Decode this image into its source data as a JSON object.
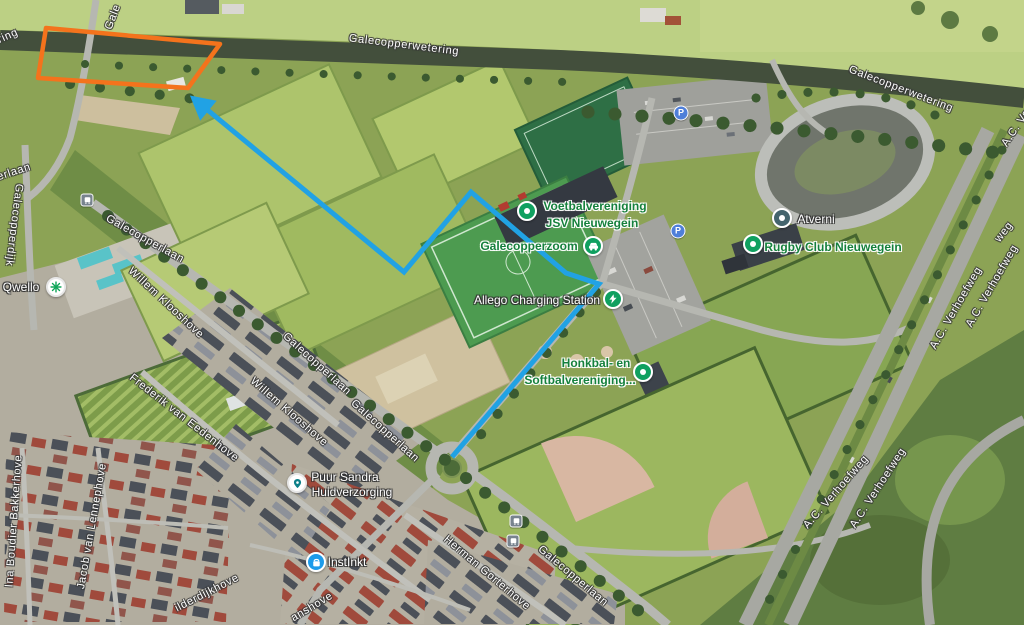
{
  "streets": {
    "galecopperwetering": "Galecopperwetering",
    "galecopperlaan": "Galecopperlaan",
    "galecopperdijk": "Galecopperdijk",
    "willem_klooshove": "Willem Klooshove",
    "frederik_van_eedenhove": "Frederik van Eedenhove",
    "ina_boudier_bakkerhove": "Ina Boudier Bakkerhove",
    "jacob_van_lennephove": "Jacob van Lennephove",
    "herman_gorterhove": "Herman Gorterhove",
    "ac_verhoefweg": "A.C. Verhoefweg",
    "partial_ring": "ring",
    "partial_gale": "Gale",
    "partial_erlaan": "erlaan",
    "partial_ilderdijkhove": "ilderdijkhove",
    "partial_anshove": "anshove",
    "partial_ac_ve": "A.C. Ve",
    "partial_weg": "weg"
  },
  "pois": {
    "jsv": {
      "line1": "Voetbalvereniging",
      "line2": "JSV Nieuwegein"
    },
    "galecopperzoom": {
      "label": "Galecopperzoom"
    },
    "allego": {
      "label": "Allego Charging Station"
    },
    "honkbal": {
      "line1": "Honkbal- en",
      "line2": "Softbalvereniging..."
    },
    "atverni": {
      "label": "Atverni"
    },
    "rugby": {
      "label": "Rugby Club Nieuwegein"
    },
    "qwello": {
      "label": "Qwello"
    },
    "puur_sandra": {
      "line1": "Puur Sandra",
      "line2": "Huidverzorging"
    },
    "instinkt": {
      "label": "InstInkt"
    }
  },
  "badges": {
    "parking_letter": "P"
  },
  "annotations": {
    "parcel_points": [
      [
        46,
        28
      ],
      [
        220,
        44
      ],
      [
        188,
        88
      ],
      [
        38,
        78
      ]
    ],
    "parcel_color": "#f4731c",
    "route_points": [
      [
        452,
        457
      ],
      [
        599,
        284
      ],
      [
        566,
        273
      ],
      [
        471,
        192
      ],
      [
        404,
        272
      ],
      [
        193,
        98
      ]
    ],
    "route_color": "#21a2e4"
  }
}
